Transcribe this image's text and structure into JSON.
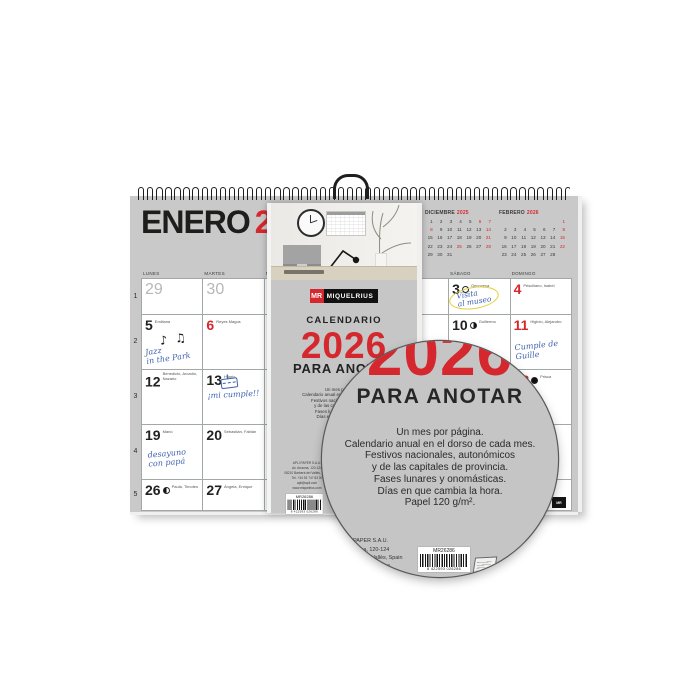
{
  "colors": {
    "accent_red": "#d5282e",
    "sheet_gray": "#c9c9c9",
    "cover_gray": "#c6c6c6",
    "handwriting_blue": "#3f62ae",
    "highlight_yellow": "#e3cf35"
  },
  "calendar_page": {
    "title_month": "ENERO",
    "title_year": "2026",
    "corner_tab": "MR",
    "weekday_headers": [
      "LUNES",
      "MARTES",
      "MIÉRCOLES",
      "JUEVES",
      "VIERNES",
      "SÁBADO",
      "DOMINGO"
    ],
    "week_numbers": [
      "1",
      "2",
      "3",
      "4",
      "5"
    ],
    "mini_calendars": [
      {
        "month": "DICIEMBRE",
        "year": "2025",
        "days": [
          [
            1,
            2,
            3,
            4,
            5,
            6,
            7
          ],
          [
            8,
            9,
            10,
            11,
            12,
            13,
            14
          ],
          [
            15,
            16,
            17,
            18,
            19,
            20,
            21
          ],
          [
            22,
            23,
            24,
            25,
            26,
            27,
            28
          ],
          [
            29,
            30,
            31,
            null,
            null,
            null,
            null
          ]
        ],
        "red_days": [
          6,
          7,
          8,
          14,
          21,
          25,
          28
        ]
      },
      {
        "month": "FEBRERO",
        "year": "2026",
        "days": [
          [
            null,
            null,
            null,
            null,
            null,
            null,
            1
          ],
          [
            2,
            3,
            4,
            5,
            6,
            7,
            8
          ],
          [
            9,
            10,
            11,
            12,
            13,
            14,
            15
          ],
          [
            16,
            17,
            18,
            19,
            20,
            21,
            22
          ],
          [
            23,
            24,
            25,
            26,
            27,
            28,
            null
          ]
        ],
        "red_days": [
          1,
          8,
          15,
          22
        ]
      }
    ],
    "notes": {
      "jazz": {
        "lines": [
          "Jazz",
          "in the Park"
        ],
        "icon": "music-notes",
        "glyphs": "♪ ♫"
      },
      "museo": {
        "lines": [
          "Visita",
          "al museo"
        ],
        "icon": "yellow-circle"
      },
      "guille": {
        "lines": [
          "Cumple de",
          "Guille"
        ],
        "icon": null
      },
      "cumple": {
        "lines": [
          "¡mi cumple!!"
        ],
        "icon": "cake-doodle"
      },
      "desayuno": {
        "lines": [
          "desayuno",
          "con papá"
        ],
        "icon": null
      }
    },
    "cells": [
      {
        "d": "29",
        "cls": "prev"
      },
      {
        "d": "30",
        "cls": "prev"
      },
      {
        "d": "31",
        "cls": "prev"
      },
      {
        "d": "1"
      },
      {
        "d": "2"
      },
      {
        "d": "3",
        "names": "Genoveva",
        "moon": "full",
        "note": "museo"
      },
      {
        "d": "4",
        "cls": "red",
        "names": "Prisciliano, Isabel"
      },
      {
        "d": "5",
        "names": "Emiliana",
        "note": "jazz"
      },
      {
        "d": "6",
        "cls": "red",
        "names": "Reyes Magos"
      },
      {
        "d": "7"
      },
      {
        "d": "8"
      },
      {
        "d": "9"
      },
      {
        "d": "10",
        "names": "Guillermo",
        "moon": "last"
      },
      {
        "d": "11",
        "cls": "red",
        "names": "Higinio, Alejandro",
        "note": "guille"
      },
      {
        "d": "12",
        "names": "Benedicto, Arcadio, Nazario"
      },
      {
        "d": "13",
        "names": "Hilario",
        "note": "cumple"
      },
      {
        "d": "14"
      },
      {
        "d": "15"
      },
      {
        "d": "16"
      },
      {
        "d": "17"
      },
      {
        "d": "18",
        "cls": "red",
        "names": "Prisca",
        "moon": "new"
      },
      {
        "d": "19",
        "names": "Mario",
        "note": "desayuno"
      },
      {
        "d": "20",
        "names": "Sebastián, Fabián"
      },
      {
        "d": "21"
      },
      {
        "d": "22"
      },
      {
        "d": "23"
      },
      {
        "d": "24"
      },
      {
        "d": "25",
        "cls": "red"
      },
      {
        "d": "26",
        "names": "Paula, Timoteo",
        "moon": "first"
      },
      {
        "d": "27",
        "names": "Ángela, Enrique"
      },
      {
        "d": "28"
      },
      {
        "d": "29"
      },
      {
        "d": "30"
      },
      {
        "d": "31"
      },
      {
        "d": "1",
        "cls": "prev"
      }
    ]
  },
  "cover": {
    "brand": "MIQUELRIUS",
    "brand_mark": "MR",
    "kicker": "CALENDARIO",
    "year": "2026",
    "title": "PARA ANOTAR",
    "description_lines": [
      "Un mes por página.",
      "Calendario anual en el dorso de cada mes.",
      "Festivos nacionales, autonómicos",
      "y de las capitales de provincia.",
      "Fases lunares y onomásticas.",
      "Días en que cambia la hora.",
      "Papel 120 g/m²."
    ],
    "company_lines": [
      "APLI PAPER S.A.U.",
      "Av. Arraona, 120-124",
      "08210 Barberà del Vallès, Spain",
      "Tel. +34 93 747 83 00",
      "apli@apli.com",
      "www.miquelrius.com"
    ],
    "barcode_label": "MR26286",
    "barcode_digits": "8 422593 026286"
  }
}
